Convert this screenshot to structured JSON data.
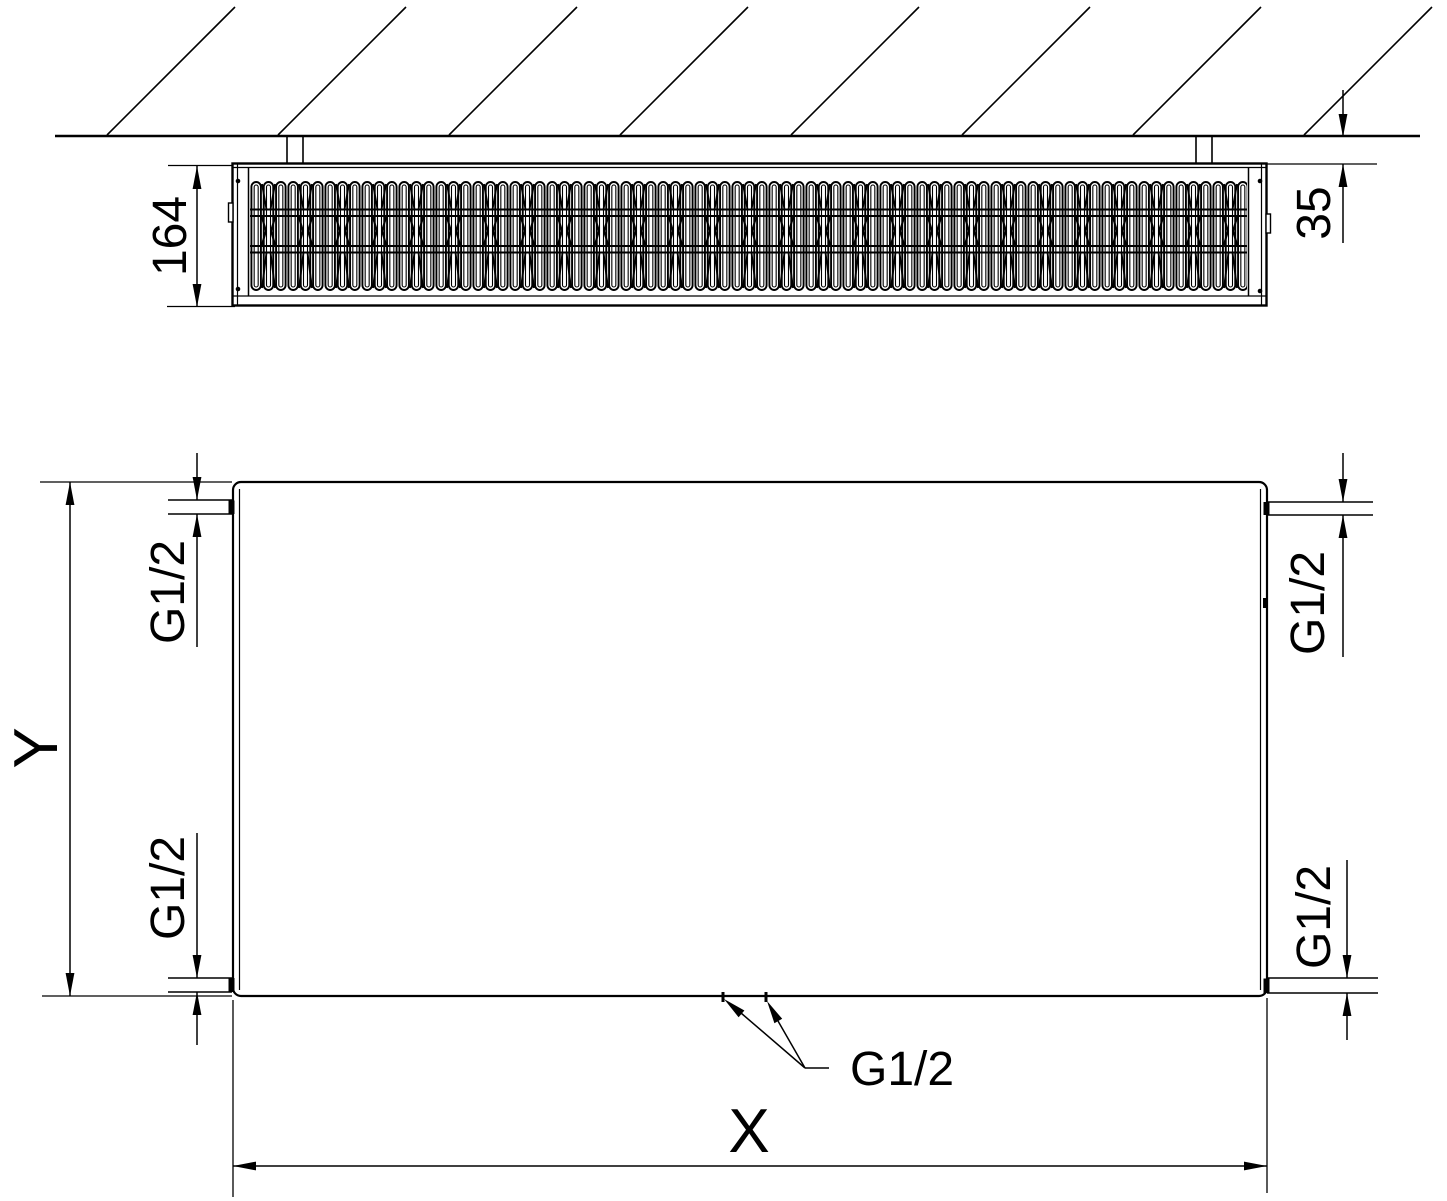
{
  "drawing": {
    "background": "#ffffff",
    "line_color": "#000000",
    "top_view": {
      "dim_depth": "164",
      "dim_wall_distance": "35"
    },
    "front_view": {
      "dim_height": "Y",
      "dim_width": "X",
      "conn_top_left": "G1/2",
      "conn_bottom_left": "G1/2",
      "conn_top_right": "G1/2",
      "conn_bottom_right": "G1/2",
      "conn_bottom_center": "G1/2"
    }
  }
}
